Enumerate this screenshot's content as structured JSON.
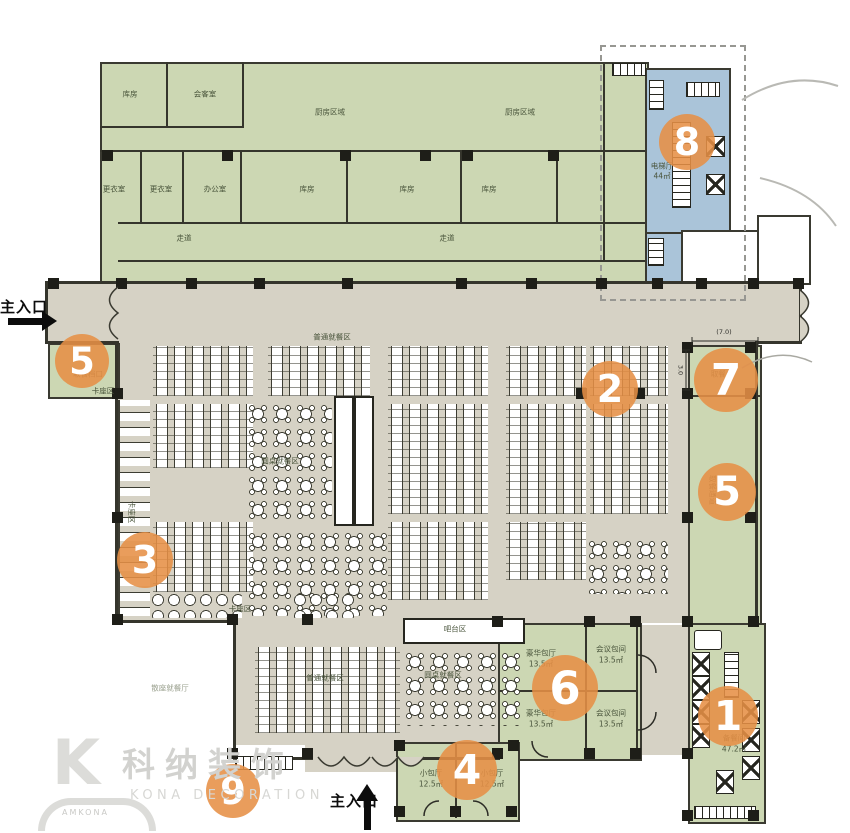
{
  "plan": {
    "company_cn": "科纳装饰",
    "company_en": "KONA DECORATION",
    "logo_letter": "K",
    "logo_arc_text": "AMKONA"
  },
  "entrances": {
    "left": "主入口",
    "bottom": "主入口"
  },
  "markers": [
    {
      "label": "8"
    },
    {
      "label": "5"
    },
    {
      "label": "2"
    },
    {
      "label": "7"
    },
    {
      "label": "5"
    },
    {
      "label": "3"
    },
    {
      "label": "6"
    },
    {
      "label": "1"
    },
    {
      "label": "4"
    },
    {
      "label": "9"
    }
  ],
  "labels": [
    {
      "t": "厨房区域"
    },
    {
      "t": "厨房区域"
    },
    {
      "t": "库房"
    },
    {
      "t": "会客室"
    },
    {
      "t": "更衣室"
    },
    {
      "t": "更衣室"
    },
    {
      "t": "办公室"
    },
    {
      "t": "库房"
    },
    {
      "t": "库房"
    },
    {
      "t": "库房"
    },
    {
      "t": "走道"
    },
    {
      "t": "走道"
    },
    {
      "t": "电梯厅"
    },
    {
      "t": "44㎡"
    },
    {
      "t": "普通就餐区"
    },
    {
      "t": "卡座区"
    },
    {
      "t": "圆桌就餐区"
    },
    {
      "t": "卡座区"
    },
    {
      "t": "卡座区"
    },
    {
      "t": "吧台区"
    },
    {
      "t": "圆桌就餐区"
    },
    {
      "t": "普通就餐区"
    },
    {
      "t": "豪华包厅"
    },
    {
      "t": "13.5㎡"
    },
    {
      "t": "会议包间"
    },
    {
      "t": "13.5㎡"
    },
    {
      "t": "豪华包厅"
    },
    {
      "t": "13.5㎡"
    },
    {
      "t": "会议包间"
    },
    {
      "t": "13.5㎡"
    },
    {
      "t": "小包厅"
    },
    {
      "t": "12.5㎡"
    },
    {
      "t": "小包厅"
    },
    {
      "t": "12.5㎡"
    },
    {
      "t": "备餐间"
    },
    {
      "t": "47.2㎡"
    },
    {
      "t": "取餐台"
    },
    {
      "t": "取餐通道"
    },
    {
      "t": "取餐档口"
    },
    {
      "t": "散座就餐厅"
    },
    {
      "t": "(7.0)"
    },
    {
      "t": "3.0"
    }
  ],
  "colors": {
    "accent_orange": "#E68F46",
    "room_green": "#CCD7B3",
    "room_blue": "#AAC4D9",
    "hall_tan": "#D6D2C5",
    "wall": "#35352C"
  }
}
